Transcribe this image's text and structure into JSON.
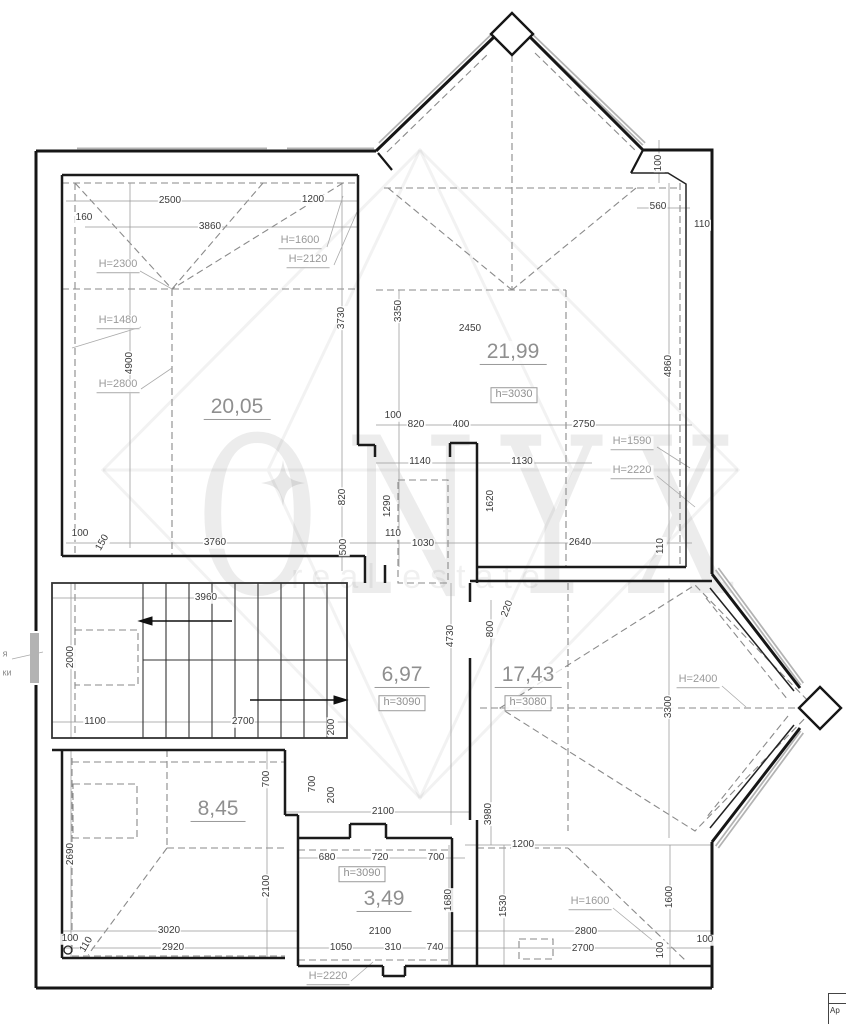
{
  "watermark": {
    "brand": "ONYX",
    "subtitle": "real estate"
  },
  "title_block": {
    "text": "Ap"
  },
  "notes": [
    {
      "t": "я",
      "x": 5,
      "y": 654
    },
    {
      "t": "ки",
      "x": 7,
      "y": 673
    }
  ],
  "rooms": [
    {
      "id": "room-20",
      "area": "20,05",
      "x": 237,
      "y": 408
    },
    {
      "id": "room-21",
      "area": "21,99",
      "x": 513,
      "y": 353,
      "h": "h=3030",
      "hx": 514,
      "hy": 395
    },
    {
      "id": "hall",
      "area": "6,97",
      "x": 402,
      "y": 676,
      "h": "h=3090",
      "hx": 402,
      "hy": 703
    },
    {
      "id": "room-17",
      "area": "17,43",
      "x": 528,
      "y": 676,
      "h": "h=3080",
      "hx": 528,
      "hy": 703
    },
    {
      "id": "room-8",
      "area": "8,45",
      "x": 218,
      "y": 810
    },
    {
      "id": "room-3",
      "area": "3,49",
      "x": 384,
      "y": 900,
      "h": "h=3090",
      "hx": 362,
      "hy": 874
    }
  ],
  "height_labels": [
    {
      "t": "H=1600",
      "x": 300,
      "y": 242
    },
    {
      "t": "H=2120",
      "x": 308,
      "y": 261
    },
    {
      "t": "H=2300",
      "x": 118,
      "y": 266
    },
    {
      "t": "H=1480",
      "x": 118,
      "y": 322
    },
    {
      "t": "H=2800",
      "x": 118,
      "y": 386
    },
    {
      "t": "H=1590",
      "x": 632,
      "y": 443
    },
    {
      "t": "H=2220",
      "x": 632,
      "y": 472
    },
    {
      "t": "H=2400",
      "x": 698,
      "y": 681
    },
    {
      "t": "H=1600",
      "x": 590,
      "y": 903
    },
    {
      "t": "H=2220",
      "x": 328,
      "y": 978
    }
  ],
  "dims": [
    {
      "t": "2500",
      "x": 170,
      "y": 201
    },
    {
      "t": "1200",
      "x": 313,
      "y": 200
    },
    {
      "t": "160",
      "x": 84,
      "y": 218
    },
    {
      "t": "3860",
      "x": 210,
      "y": 227
    },
    {
      "t": "2450",
      "x": 470,
      "y": 329
    },
    {
      "t": "560",
      "x": 658,
      "y": 207
    },
    {
      "t": "110",
      "x": 702,
      "y": 225
    },
    {
      "t": "100",
      "x": 659,
      "y": 163,
      "r": -90
    },
    {
      "t": "4900",
      "x": 130,
      "y": 363,
      "r": -90
    },
    {
      "t": "3730",
      "x": 342,
      "y": 318,
      "r": -90
    },
    {
      "t": "3350",
      "x": 399,
      "y": 311,
      "r": -90
    },
    {
      "t": "4860",
      "x": 669,
      "y": 366,
      "r": -90
    },
    {
      "t": "100",
      "x": 393,
      "y": 416
    },
    {
      "t": "820",
      "x": 416,
      "y": 425
    },
    {
      "t": "400",
      "x": 461,
      "y": 425
    },
    {
      "t": "2750",
      "x": 584,
      "y": 425
    },
    {
      "t": "1140",
      "x": 420,
      "y": 462
    },
    {
      "t": "1130",
      "x": 522,
      "y": 462
    },
    {
      "t": "820",
      "x": 343,
      "y": 497,
      "r": -90
    },
    {
      "t": "1290",
      "x": 388,
      "y": 506,
      "r": -90
    },
    {
      "t": "1620",
      "x": 491,
      "y": 501,
      "r": -90
    },
    {
      "t": "500",
      "x": 344,
      "y": 547,
      "r": -90
    },
    {
      "t": "100",
      "x": 80,
      "y": 534
    },
    {
      "t": "150",
      "x": 103,
      "y": 543,
      "r": -60
    },
    {
      "t": "3760",
      "x": 215,
      "y": 543
    },
    {
      "t": "110",
      "x": 393,
      "y": 534
    },
    {
      "t": "1030",
      "x": 423,
      "y": 544
    },
    {
      "t": "2640",
      "x": 580,
      "y": 543
    },
    {
      "t": "110",
      "x": 661,
      "y": 546,
      "r": -90
    },
    {
      "t": "3960",
      "x": 206,
      "y": 598
    },
    {
      "t": "2000",
      "x": 71,
      "y": 657,
      "r": -90
    },
    {
      "t": "1100",
      "x": 95,
      "y": 722
    },
    {
      "t": "2700",
      "x": 243,
      "y": 722
    },
    {
      "t": "200",
      "x": 332,
      "y": 727,
      "r": -90
    },
    {
      "t": "4730",
      "x": 451,
      "y": 636,
      "r": -90
    },
    {
      "t": "800",
      "x": 491,
      "y": 629,
      "r": -90
    },
    {
      "t": "220",
      "x": 508,
      "y": 609,
      "r": -70
    },
    {
      "t": "3300",
      "x": 669,
      "y": 707,
      "r": -90
    },
    {
      "t": "700",
      "x": 267,
      "y": 779,
      "r": -90
    },
    {
      "t": "700",
      "x": 313,
      "y": 784,
      "r": -90
    },
    {
      "t": "200",
      "x": 332,
      "y": 795,
      "r": -90
    },
    {
      "t": "2100",
      "x": 383,
      "y": 812
    },
    {
      "t": "2690",
      "x": 71,
      "y": 854,
      "r": -90
    },
    {
      "t": "2100",
      "x": 267,
      "y": 886,
      "r": -90
    },
    {
      "t": "3980",
      "x": 489,
      "y": 814,
      "r": -90
    },
    {
      "t": "1200",
      "x": 523,
      "y": 845
    },
    {
      "t": "680",
      "x": 327,
      "y": 858
    },
    {
      "t": "720",
      "x": 380,
      "y": 858
    },
    {
      "t": "700",
      "x": 436,
      "y": 858
    },
    {
      "t": "1680",
      "x": 449,
      "y": 900,
      "r": -90
    },
    {
      "t": "1530",
      "x": 504,
      "y": 906,
      "r": -90
    },
    {
      "t": "1600",
      "x": 670,
      "y": 897,
      "r": -90
    },
    {
      "t": "3020",
      "x": 169,
      "y": 931
    },
    {
      "t": "100",
      "x": 70,
      "y": 939
    },
    {
      "t": "2920",
      "x": 173,
      "y": 948
    },
    {
      "t": "110",
      "x": 87,
      "y": 945,
      "r": -60
    },
    {
      "t": "2100",
      "x": 380,
      "y": 932
    },
    {
      "t": "1050",
      "x": 341,
      "y": 948
    },
    {
      "t": "310",
      "x": 393,
      "y": 948
    },
    {
      "t": "740",
      "x": 435,
      "y": 948
    },
    {
      "t": "2800",
      "x": 586,
      "y": 932
    },
    {
      "t": "2700",
      "x": 583,
      "y": 949
    },
    {
      "t": "100",
      "x": 705,
      "y": 940
    },
    {
      "t": "100",
      "x": 661,
      "y": 950,
      "r": -90
    }
  ]
}
